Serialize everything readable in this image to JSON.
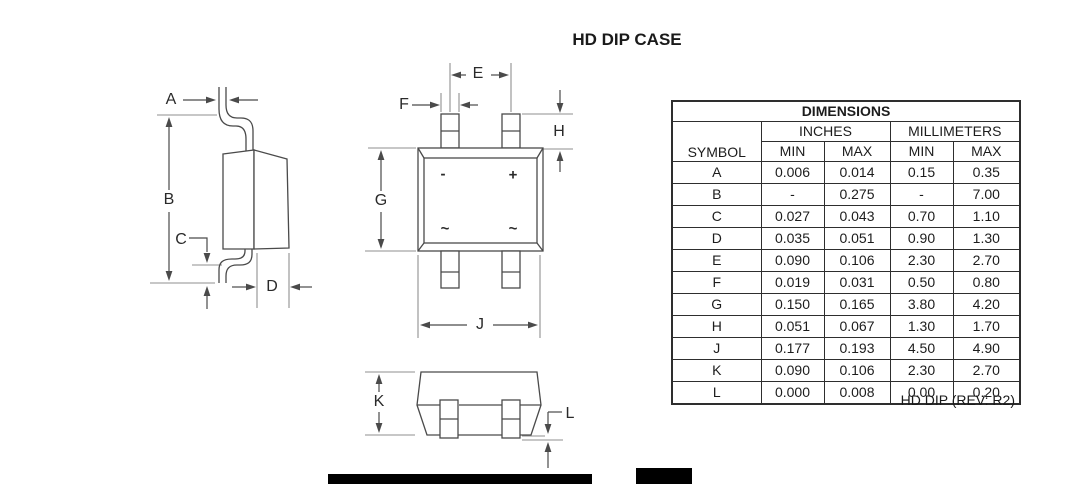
{
  "title": "HD DIP CASE",
  "table": {
    "header": "DIMENSIONS",
    "symbol_header": "SYMBOL",
    "unit_groups": [
      "INCHES",
      "MILLIMETERS"
    ],
    "col_headers": [
      "MIN",
      "MAX",
      "MIN",
      "MAX"
    ],
    "rows": [
      {
        "symbol": "A",
        "in_min": "0.006",
        "in_max": "0.014",
        "mm_min": "0.15",
        "mm_max": "0.35"
      },
      {
        "symbol": "B",
        "in_min": "-",
        "in_max": "0.275",
        "mm_min": "-",
        "mm_max": "7.00"
      },
      {
        "symbol": "C",
        "in_min": "0.027",
        "in_max": "0.043",
        "mm_min": "0.70",
        "mm_max": "1.10"
      },
      {
        "symbol": "D",
        "in_min": "0.035",
        "in_max": "0.051",
        "mm_min": "0.90",
        "mm_max": "1.30"
      },
      {
        "symbol": "E",
        "in_min": "0.090",
        "in_max": "0.106",
        "mm_min": "2.30",
        "mm_max": "2.70"
      },
      {
        "symbol": "F",
        "in_min": "0.019",
        "in_max": "0.031",
        "mm_min": "0.50",
        "mm_max": "0.80"
      },
      {
        "symbol": "G",
        "in_min": "0.150",
        "in_max": "0.165",
        "mm_min": "3.80",
        "mm_max": "4.20"
      },
      {
        "symbol": "H",
        "in_min": "0.051",
        "in_max": "0.067",
        "mm_min": "1.30",
        "mm_max": "1.70"
      },
      {
        "symbol": "J",
        "in_min": "0.177",
        "in_max": "0.193",
        "mm_min": "4.50",
        "mm_max": "4.90"
      },
      {
        "symbol": "K",
        "in_min": "0.090",
        "in_max": "0.106",
        "mm_min": "2.30",
        "mm_max": "2.70"
      },
      {
        "symbol": "L",
        "in_min": "0.000",
        "in_max": "0.008",
        "mm_min": "0.00",
        "mm_max": "0.20"
      }
    ],
    "caption": "HD DIP (REV: R2)"
  },
  "dim_labels": {
    "A": "A",
    "B": "B",
    "C": "C",
    "D": "D",
    "E": "E",
    "F": "F",
    "G": "G",
    "H": "H",
    "J": "J",
    "K": "K",
    "L": "L"
  },
  "polarity": {
    "minus": "-",
    "plus": "+",
    "ac1": "~",
    "ac2": "~"
  },
  "colors": {
    "background": "#ffffff",
    "outline": "#4a4a4a",
    "extension_line": "#8f8f8f",
    "text": "#1c1c1c",
    "footer_bar": "#000000"
  }
}
